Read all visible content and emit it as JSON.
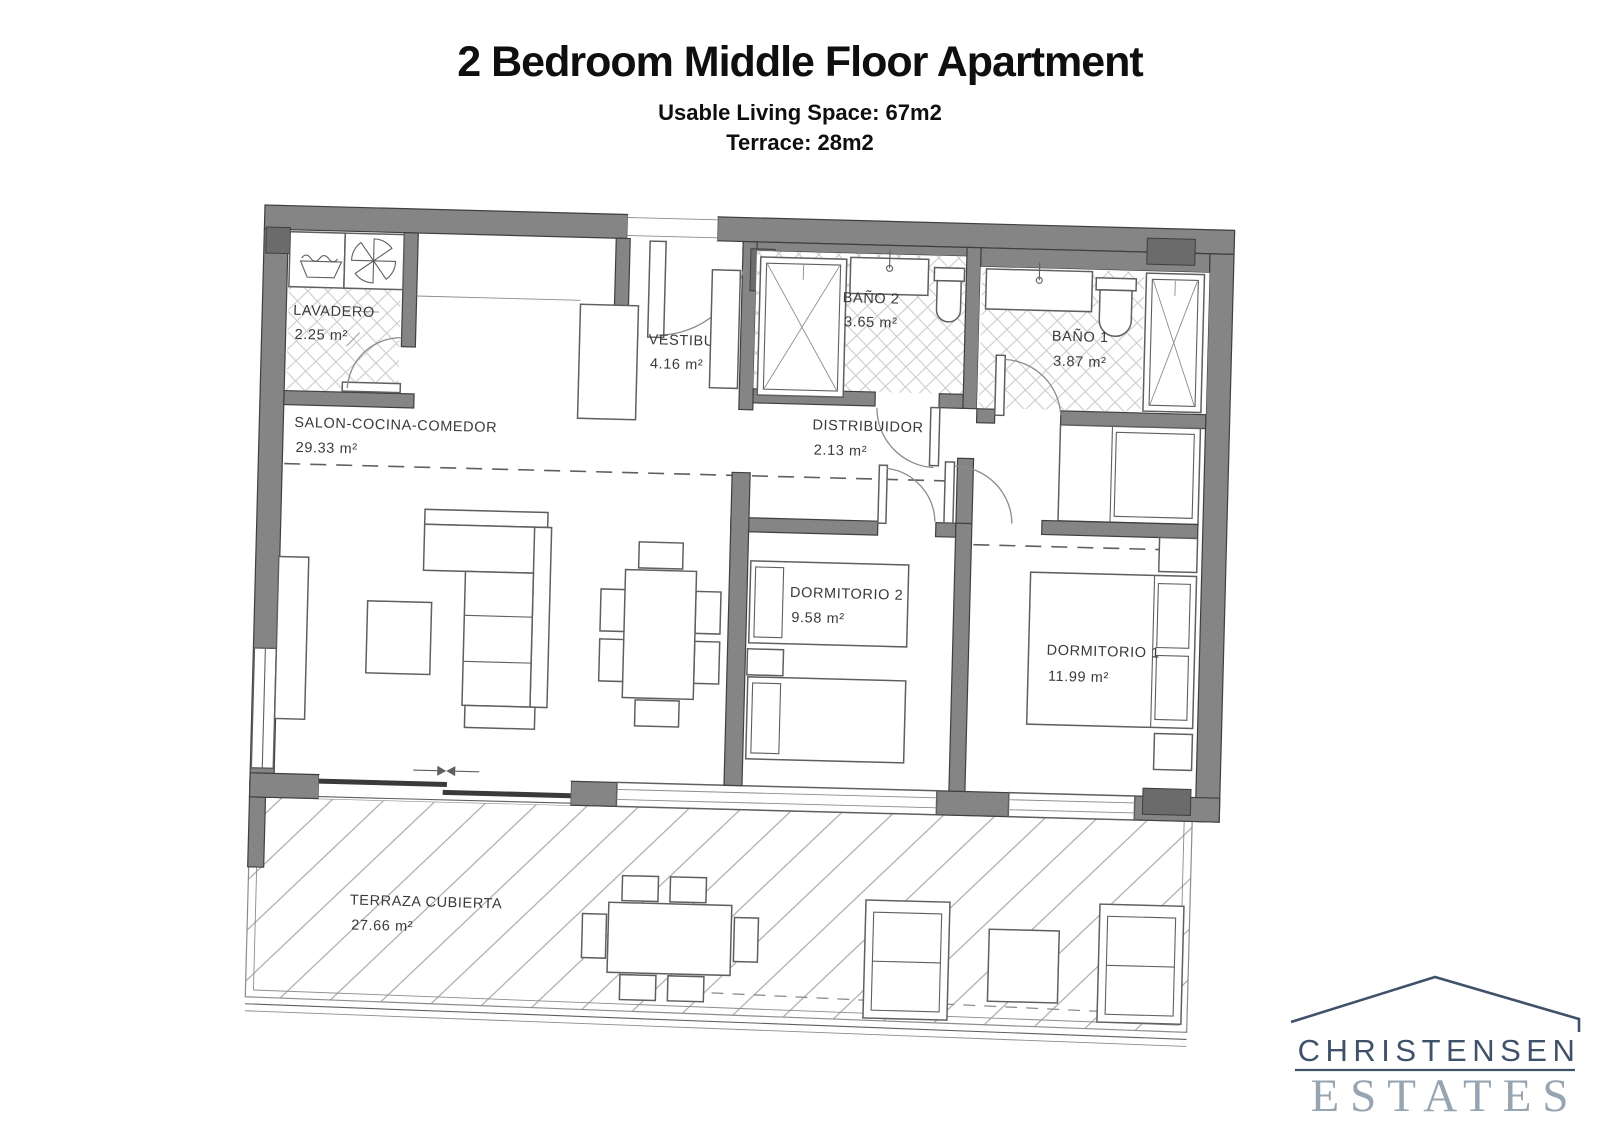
{
  "header": {
    "title": "2 Bedroom Middle Floor Apartment",
    "subtitle1": "Usable Living Space: 67m2",
    "subtitle2": "Terrace: 28m2"
  },
  "floorplan": {
    "rooms": [
      {
        "name": "LAVADERO",
        "area": "2.25 m²"
      },
      {
        "name": "VESTIBULO",
        "area": "4.16 m²"
      },
      {
        "name": "BAÑO 2",
        "area": "3.65 m²"
      },
      {
        "name": "BAÑO 1",
        "area": "3.87 m²"
      },
      {
        "name": "SALON-COCINA-COMEDOR",
        "area": "29.33 m²"
      },
      {
        "name": "DISTRIBUIDOR",
        "area": "2.13 m²"
      },
      {
        "name": "DORMITORIO 2",
        "area": "9.58 m²"
      },
      {
        "name": "DORMITORIO 1",
        "area": "11.99 m²"
      },
      {
        "name": "TERRAZA CUBIERTA",
        "area": "27.66 m²"
      }
    ],
    "icons": [
      "laundry-basin-icon",
      "fan-icon",
      "shower-icon",
      "washbasin-icon",
      "toilet-icon",
      "sofa-icon",
      "coffee-table-icon",
      "dining-table-icon",
      "bed-icon",
      "wardrobe-icon",
      "lounge-chair-icon",
      "sliding-door-arrows"
    ]
  },
  "logo": {
    "line1": "CHRISTENSEN",
    "line2": "ESTATES"
  },
  "colors": {
    "title": "#0f0f0f",
    "label": "#3a3a3a",
    "wall": "#858585",
    "wall-dark": "#6b6b6b",
    "wall-edge": "#3f3f3f",
    "line": "#5f5f5f",
    "line-light": "#8c8c8c",
    "hatch": "#cbcbcb",
    "terrace-hatch": "#a9a9a9",
    "slat": "#3a3a3a",
    "logo-dark": "#40526a",
    "logo-light": "#97a4b1"
  }
}
